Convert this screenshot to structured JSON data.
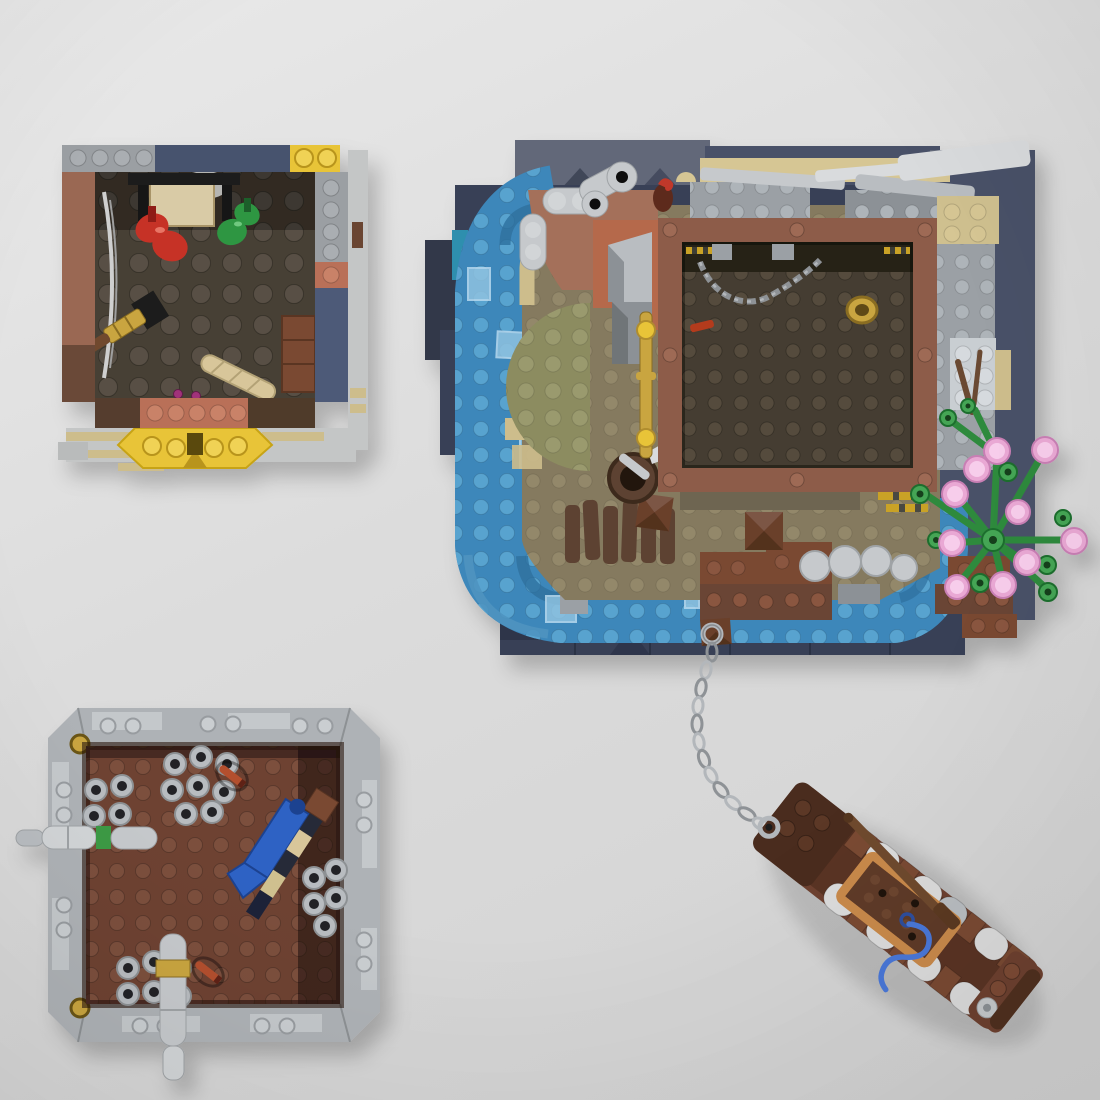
{
  "meta": {
    "title": "LEGO MOC modules - top-down render",
    "description": "Top-down render of four LEGO builds: a potion room module, a main island with ruined building and moat, a storage room module, and a rowing boat tied to the island by a chain.",
    "width_px": 1100,
    "height_px": 1100,
    "visible_text": ""
  },
  "palette": {
    "bg_top": "#e9e9e9",
    "bg_mid": "#dcdcdc",
    "bg_bottom": "#d2d2d2",
    "navy": "#394056",
    "navy_dark": "#303749",
    "navy_light": "#626879",
    "navy_mid": "#4a5168",
    "navy_prism": "#242a3e",
    "navy_seam": "#2b3144",
    "water": "#3d87ba",
    "water_stud": "#58a3cf",
    "water_deep": "#2d6f9e",
    "water_step": "#4f93c0",
    "water_tile": "#8fc2e0",
    "teal": "#2e8fae",
    "olive": "#8c8c60",
    "olive_stud": "#9a9a6e",
    "ground": "#857a5e",
    "ground_stud": "#93886b",
    "ground_dark": "#6e6551",
    "tan_wall": "#d6c694",
    "tan_brick": "#cfc08f",
    "tan_pale": "#cdbd8c",
    "nougat": "#b5694b",
    "brown_top": "#a4705a",
    "brick_brown": "#7a4a33",
    "brick_brown_stud": "#8a563f",
    "dark_brown": "#4a2c1e",
    "plank": "#5d4232",
    "dock_brown": "#6a4534",
    "pyramid": "#6a3f2c",
    "pyramid_dark": "#53301f",
    "frame_brown": "#8d5c49",
    "frame_stud": "#9e6a55",
    "shelf_dark": "#272219",
    "floor_b": "#443c31",
    "floor_b_stud": "#554b3d",
    "graybrick": "#9ba0a5",
    "graybrick_stud": "#aeb4b9",
    "gray_light": "#c6c9cc",
    "gray_lighter": "#d9dbdd",
    "gray_mid": "#8c9196",
    "white_brick": "#c9ced2",
    "gold": "#c9a53f",
    "gold_dark": "#8a6d20",
    "yellow": "#e8c437",
    "yellow_dark": "#b8941a",
    "hazard": "#c9a227",
    "chain": "#b3b7bb",
    "chain_dark": "#8e9296",
    "tree": "#2f8a3e",
    "tree_light": "#44a554",
    "twig": "#6a4a30",
    "pink": "#e9a8d4",
    "pink_light": "#f7cdeb",
    "pink_edge": "#d98cc4",
    "wallA_brown": "#9a6752",
    "wallA_navy": "#46536e",
    "wallA_navy2": "#4d5a78",
    "salmon": "#b97059",
    "floor_a": "#474034",
    "floor_a_stud": "#585045",
    "red": "#c63226",
    "green": "#2f9642",
    "magenta": "#a0307a",
    "box_tan": "#d9cba6",
    "baguette": "#d8c69a",
    "black_piece": "#1a1a1a",
    "wallC": "#aeb2b6",
    "wallC_light": "#c7cbce",
    "wallC_stud": "#caced1",
    "wallC_edge": "#8d9194",
    "floor_c": "#6e4232",
    "floor_c_stud": "#7b4f3e",
    "barrel": "#b8bcc0",
    "barrel_hole": "#232327",
    "pipe": "#c6c9cc",
    "pipe_light": "#d2d5d7",
    "green_band": "#3e9a45",
    "crossbow_blue": "#2f62c4",
    "stripe_dark": "#262b38",
    "dynamite": "#b3502e",
    "boat_hull": "#6e4130",
    "boat_hull_dark": "#5a3424",
    "boat_bow": "#4a2c1e",
    "boat_nougat": "#c98a4b",
    "boat_deck": "#5f3b28",
    "roller": "#dcdcdc",
    "roller_shade": "#b9bdc1",
    "rope_blue": "#4a78d8",
    "oar": "#6f4a2e",
    "shadow": "rgba(0,0,0,0.20)"
  },
  "modules": {
    "potion_room": {
      "name": "Potion room module (top left)",
      "objects": [
        "gray-navy-yellow walls",
        "red potion sack",
        "green potion sack",
        "tan chest",
        "spyglass",
        "baguette",
        "wooden crate",
        "yellow boat-bow piece"
      ]
    },
    "island": {
      "name": "Main island build (center right)",
      "objects": [
        "stepped navy baseplates",
        "blue water moat",
        "olive lawn",
        "nougat terrace",
        "ruined roof planks",
        "building with hanging chain",
        "gold lantern post",
        "well with shovel",
        "wooden dock",
        "boulders",
        "blossom tree",
        "anchor chain ring"
      ]
    },
    "storage_room": {
      "name": "Storage room module (bottom left)",
      "objects": [
        "gray beveled walls",
        "barrel stacks",
        "horizontal pipe with green band",
        "vertical pipe with gold band",
        "blue crossbow",
        "dynamite sticks",
        "pearl-gold corner rounds"
      ]
    },
    "boat": {
      "name": "Rowing boat (bottom right)",
      "objects": [
        "dark brown bow with chain ring",
        "white cargo rollers",
        "nougat cargo frame",
        "oar",
        "blue rope",
        "stern winch disc"
      ]
    },
    "chain": {
      "name": "Anchor chain linking island and boat"
    }
  }
}
